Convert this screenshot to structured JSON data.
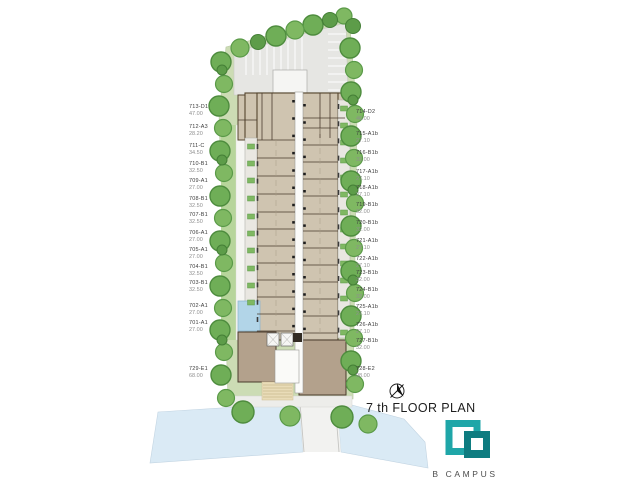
{
  "title": "7 th  FLOOR PLAN",
  "brand": {
    "name": "B CAMPUS"
  },
  "palette": {
    "logo_teal": "#1FA6A8",
    "logo_dark_teal": "#0E7C80",
    "site_green": "#CCDCB4",
    "tree_green": "#6FAE57",
    "parking_gray": "#E6E6E3",
    "unit_tan": "#CFC4B0",
    "unit_dark_tan": "#B3A18C",
    "wall_brown": "#4A3B2D",
    "pool_blue": "#B2D5E8",
    "canal_blue": "#DAEAF5",
    "label_text": "#3D3D3D",
    "area_text": "#8F8F8F"
  },
  "units_left": [
    {
      "id": "713-D1",
      "area": "47.00",
      "top": 104
    },
    {
      "id": "712-A3",
      "area": "28.20",
      "top": 124
    },
    {
      "id": "711-C",
      "area": "34.50",
      "top": 143
    },
    {
      "id": "710-B1",
      "area": "32.50",
      "top": 161
    },
    {
      "id": "709-A1",
      "area": "27.00",
      "top": 178
    },
    {
      "id": "708-B1",
      "area": "32.50",
      "top": 196
    },
    {
      "id": "707-B1",
      "area": "32.50",
      "top": 212
    },
    {
      "id": "706-A1",
      "area": "27.00",
      "top": 230
    },
    {
      "id": "705-A1",
      "area": "27.00",
      "top": 247
    },
    {
      "id": "704-B1",
      "area": "32.50",
      "top": 264
    },
    {
      "id": "703-B1",
      "area": "32.50",
      "top": 280
    },
    {
      "id": "702-A1",
      "area": "27.00",
      "top": 303
    },
    {
      "id": "701-A1",
      "area": "27.00",
      "top": 320
    },
    {
      "id": "729-E1",
      "area": "68.00",
      "top": 366
    }
  ],
  "units_right": [
    {
      "id": "714-D2",
      "area": "46.00",
      "top": 109
    },
    {
      "id": "715-A1b",
      "area": "27.10",
      "top": 131
    },
    {
      "id": "716-B1b",
      "area": "32.00",
      "top": 150
    },
    {
      "id": "717-A1b",
      "area": "27.10",
      "top": 169
    },
    {
      "id": "718-A1b",
      "area": "27.10",
      "top": 185
    },
    {
      "id": "719-B1b",
      "area": "32.00",
      "top": 202
    },
    {
      "id": "720-B1b",
      "area": "32.00",
      "top": 220
    },
    {
      "id": "721-A1b",
      "area": "27.10",
      "top": 238
    },
    {
      "id": "722-A1b",
      "area": "27.10",
      "top": 256
    },
    {
      "id": "723-B1b",
      "area": "32.00",
      "top": 270
    },
    {
      "id": "724-B1b",
      "area": "32.00",
      "top": 287
    },
    {
      "id": "725-A1b",
      "area": "27.10",
      "top": 304
    },
    {
      "id": "726-A1b",
      "area": "27.10",
      "top": 322
    },
    {
      "id": "727-B1b",
      "area": "32.00",
      "top": 338
    },
    {
      "id": "728-E2",
      "area": "98.00",
      "top": 366
    }
  ]
}
